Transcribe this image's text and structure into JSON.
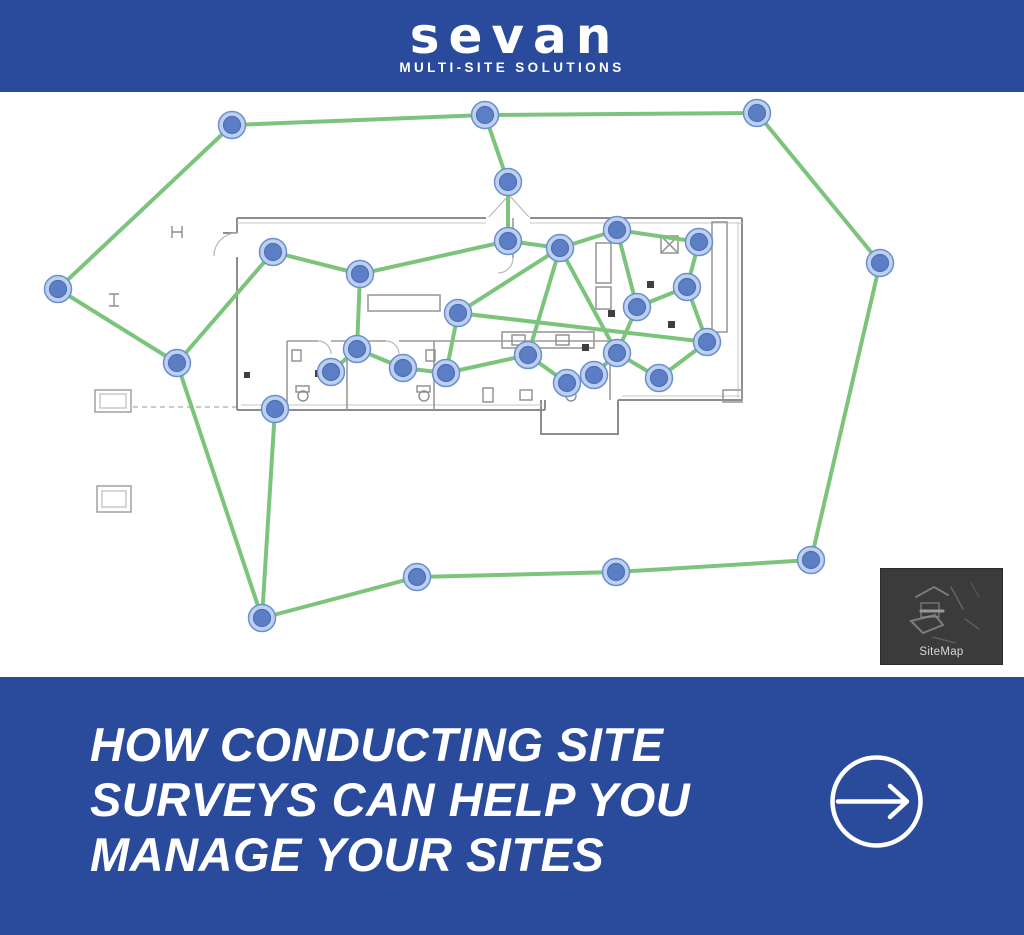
{
  "header": {
    "logo_text": "sevan",
    "tagline": "MULTI-SITE SOLUTIONS"
  },
  "map": {
    "sitemap_label": "SiteMap",
    "nodes": [
      [
        232,
        125
      ],
      [
        485,
        115
      ],
      [
        757,
        113
      ],
      [
        880,
        263
      ],
      [
        811,
        560
      ],
      [
        616,
        572
      ],
      [
        417,
        577
      ],
      [
        262,
        618
      ],
      [
        177,
        363
      ],
      [
        58,
        289
      ],
      [
        508,
        182
      ],
      [
        508,
        241
      ],
      [
        560,
        248
      ],
      [
        617,
        230
      ],
      [
        699,
        242
      ],
      [
        687,
        287
      ],
      [
        637,
        307
      ],
      [
        707,
        342
      ],
      [
        659,
        378
      ],
      [
        617,
        353
      ],
      [
        594,
        375
      ],
      [
        567,
        383
      ],
      [
        528,
        355
      ],
      [
        446,
        373
      ],
      [
        403,
        368
      ],
      [
        458,
        313
      ],
      [
        357,
        349
      ],
      [
        331,
        372
      ],
      [
        360,
        274
      ],
      [
        273,
        252
      ],
      [
        275,
        409
      ]
    ],
    "edges": [
      [
        0,
        1
      ],
      [
        1,
        2
      ],
      [
        2,
        3
      ],
      [
        3,
        4
      ],
      [
        4,
        5
      ],
      [
        5,
        6
      ],
      [
        6,
        7
      ],
      [
        7,
        8
      ],
      [
        8,
        9
      ],
      [
        9,
        0
      ],
      [
        1,
        10
      ],
      [
        10,
        11
      ],
      [
        7,
        30
      ],
      [
        8,
        29
      ],
      [
        11,
        12
      ],
      [
        11,
        28
      ],
      [
        12,
        13
      ],
      [
        12,
        25
      ],
      [
        12,
        22
      ],
      [
        12,
        19
      ],
      [
        13,
        14
      ],
      [
        13,
        16
      ],
      [
        14,
        15
      ],
      [
        15,
        16
      ],
      [
        15,
        17
      ],
      [
        16,
        19
      ],
      [
        17,
        18
      ],
      [
        17,
        25
      ],
      [
        18,
        19
      ],
      [
        19,
        20
      ],
      [
        20,
        21
      ],
      [
        21,
        22
      ],
      [
        22,
        23
      ],
      [
        23,
        24
      ],
      [
        23,
        25
      ],
      [
        26,
        27
      ],
      [
        26,
        24
      ],
      [
        26,
        28
      ],
      [
        28,
        29
      ]
    ]
  },
  "footer": {
    "headline_lines": [
      "HOW CONDUCTING SITE",
      "SURVEYS CAN HELP YOU",
      "MANAGE YOUR SITES"
    ]
  },
  "theme": {
    "brand_blue": "#2a4a9c",
    "survey_green": "#7cc47b",
    "node_ring": "#bdd1ee",
    "node_fill": "#5b7ec5",
    "node_stroke": "#6a8fd2",
    "node_inner_stroke": "#4d70b6",
    "plan_gray": "#8d8d8d",
    "thumb_bg": "#3b3b3b",
    "thumb_text": "#d6d6d6"
  }
}
